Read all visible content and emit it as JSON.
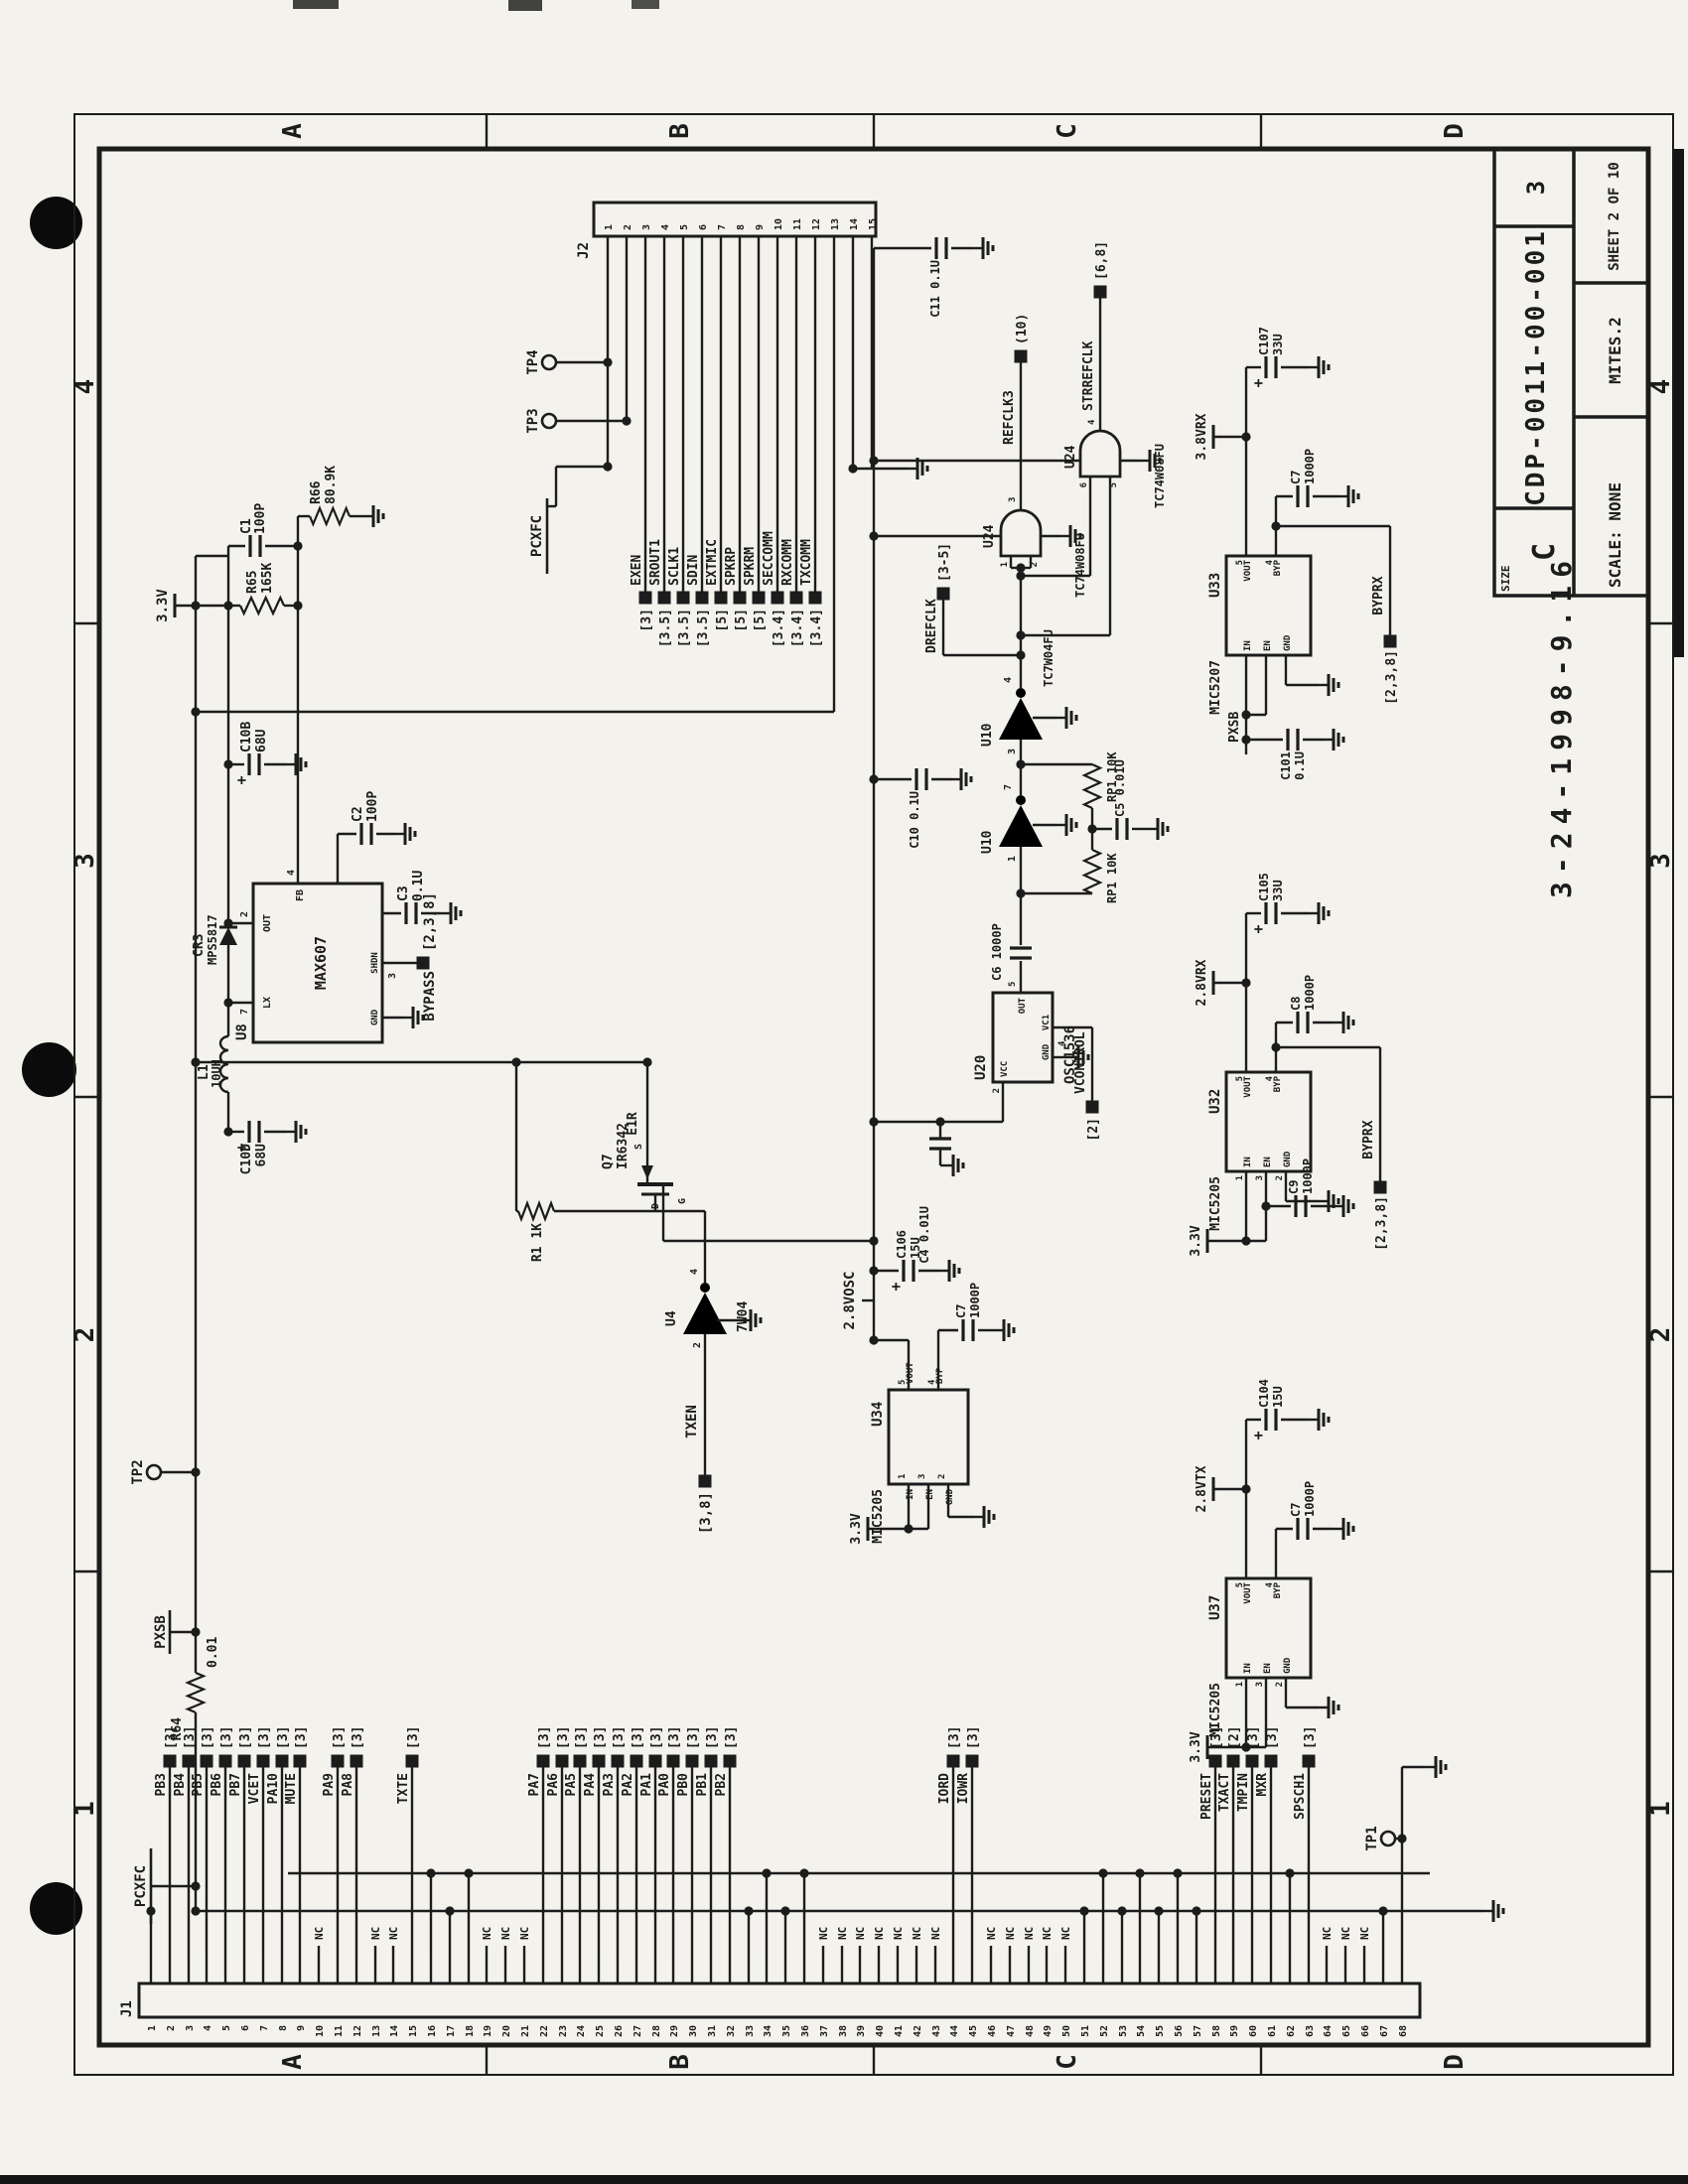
{
  "title_block": {
    "size_label": "SIZE",
    "size": "C",
    "drawing_number": "CDP-0011-00-001",
    "rev": "3",
    "scale": "SCALE: NONE",
    "code": "MITES.2",
    "sheet": "SHEET 2 OF 10",
    "date_stamp": "3-24-1998-9.16"
  },
  "zones": {
    "letters": [
      "A",
      "B",
      "C",
      "D"
    ],
    "numbers": [
      "1",
      "2",
      "3",
      "4"
    ]
  },
  "test_points": [
    "TP1",
    "TP2",
    "TP3",
    "TP4"
  ],
  "power_nets": {
    "v33": "3.3V",
    "v28osc": "2.8VOSC",
    "v28rx": "2.8VRX",
    "v28tx": "2.8VTX",
    "v38rx": "3.8VRX",
    "pxsb": "PXSB",
    "pcxfc": "PCXFC"
  },
  "net_flags": {
    "txen": {
      "net": "TXEN",
      "ref": "[3,8]"
    },
    "bypass": {
      "net": "BYPASS",
      "ref": "[2,3,8]"
    },
    "byprx": {
      "net": "BYPRX",
      "ref": "[2,3,8]"
    },
    "vcontrol": {
      "net": "VCONTROL",
      "ref": "[2]"
    },
    "drefclk": {
      "net": "DREFCLK",
      "ref": "[3-5]"
    },
    "refclk3": {
      "net": "REFCLK3",
      "ref": "(10)"
    },
    "strrefclk": {
      "net": "STRREFCLK",
      "ref": "[6,8]"
    },
    "e1r": {
      "net": "E1R",
      "ref": ""
    }
  },
  "components": {
    "U8": {
      "ref": "U8",
      "part": "MAX607"
    },
    "U10": {
      "ref": "U10",
      "part": "TC7W04FU"
    },
    "U24": {
      "ref": "U24",
      "part": "TC74W08FU"
    },
    "U20": {
      "ref": "U20",
      "part": "OSC1536"
    },
    "U4": {
      "ref": "U4",
      "part": "7W04"
    },
    "U32": {
      "ref": "U32",
      "part": "MIC5205"
    },
    "U33": {
      "ref": "U33",
      "part": "MIC5207"
    },
    "U34": {
      "ref": "U34",
      "part": "MIC5205"
    },
    "U37": {
      "ref": "U37",
      "part": "MIC5205"
    },
    "Q7": {
      "ref": "Q7",
      "part": "IR6342"
    },
    "L1": {
      "ref": "L1",
      "value": "10UH"
    },
    "CR3": {
      "ref": "CR3",
      "part": "MPS5817"
    },
    "R1": {
      "ref": "R1",
      "value": "1K"
    },
    "R64": {
      "ref": "R64",
      "value": "0.01"
    },
    "R65": {
      "ref": "R65",
      "value": "165K"
    },
    "R66": {
      "ref": "R66",
      "value": "80.9K"
    },
    "RP1": {
      "ref": "RP1",
      "value": "10K"
    },
    "C1": {
      "ref": "C1",
      "value": "100P"
    },
    "C2": {
      "ref": "C2",
      "value": "100P"
    },
    "C3": {
      "ref": "C3",
      "value": "0.1U"
    },
    "C4": {
      "ref": "C4",
      "value": "0.01U"
    },
    "C5": {
      "ref": "C5",
      "value": "0.01U"
    },
    "C6": {
      "ref": "C6",
      "value": "1000P"
    },
    "C7": {
      "ref": "C7",
      "value": "1000P"
    },
    "C8": {
      "ref": "C8",
      "value": "1000P"
    },
    "C9": {
      "ref": "C9",
      "value": "1000P"
    },
    "C10": {
      "ref": "C10",
      "value": "0.1U"
    },
    "C11": {
      "ref": "C11",
      "value": "0.1U"
    },
    "C101": {
      "ref": "C101",
      "value": "0.1U"
    },
    "C104": {
      "ref": "C104",
      "value": "15U"
    },
    "C105": {
      "ref": "C105",
      "value": "33U"
    },
    "C106": {
      "ref": "C106",
      "value": "15U"
    },
    "C107": {
      "ref": "C107",
      "value": "33U"
    },
    "C10B": {
      "ref": "C10B",
      "value": "68U"
    },
    "C10D": {
      "ref": "C10D",
      "value": "68U"
    }
  },
  "pin_names": {
    "in": "IN",
    "en": "EN",
    "gnd": "GND",
    "vout": "VOUT",
    "byp": "BYP",
    "vcc": "VCC",
    "out": "OUT",
    "lx": "LX",
    "fb": "FB",
    "shdn": "SHDN",
    "vc1": "VC1",
    "g": "G",
    "s": "S",
    "d": "D"
  },
  "nc": "NC",
  "connectors": {
    "J2": {
      "label": "J2",
      "pin_count": 15,
      "net_labels": [
        {
          "pin": 3,
          "net": "EXEN",
          "ref": "[3]"
        },
        {
          "pin": 4,
          "net": "SROUT1",
          "ref": "[3.5]"
        },
        {
          "pin": 5,
          "net": "SCLK1",
          "ref": "[3.5]"
        },
        {
          "pin": 6,
          "net": "SDIN",
          "ref": "[3.5]"
        },
        {
          "pin": 7,
          "net": "EXTMIC",
          "ref": "[5]"
        },
        {
          "pin": 8,
          "net": "SPKRP",
          "ref": "[5]"
        },
        {
          "pin": 9,
          "net": "SPKRM",
          "ref": "[5]"
        },
        {
          "pin": 10,
          "net": "SECCOMM",
          "ref": "[3.4]"
        },
        {
          "pin": 11,
          "net": "RXCOMM",
          "ref": "[3.4]"
        },
        {
          "pin": 12,
          "net": "TXCOMM",
          "ref": "[3.4]"
        }
      ]
    },
    "J1": {
      "label": "J1",
      "pin_count": 68,
      "net_labels": [
        {
          "pin": 2,
          "net": "PB3",
          "ref": "[3]"
        },
        {
          "pin": 3,
          "net": "PB4",
          "ref": "[3]"
        },
        {
          "pin": 4,
          "net": "PB5",
          "ref": "[3]"
        },
        {
          "pin": 5,
          "net": "PB6",
          "ref": "[3]"
        },
        {
          "pin": 6,
          "net": "PB7",
          "ref": "[3]"
        },
        {
          "pin": 7,
          "net": "VCET",
          "ref": "[3]"
        },
        {
          "pin": 8,
          "net": "PA10",
          "ref": "[3]"
        },
        {
          "pin": 9,
          "net": "MUTE",
          "ref": "[3]"
        },
        {
          "pin": 11,
          "net": "PA9",
          "ref": "[3]"
        },
        {
          "pin": 12,
          "net": "PA8",
          "ref": "[3]"
        },
        {
          "pin": 15,
          "net": "TXTE",
          "ref": "[3]"
        },
        {
          "pin": 22,
          "net": "PA7",
          "ref": "[3]"
        },
        {
          "pin": 23,
          "net": "PA6",
          "ref": "[3]"
        },
        {
          "pin": 24,
          "net": "PA5",
          "ref": "[3]"
        },
        {
          "pin": 25,
          "net": "PA4",
          "ref": "[3]"
        },
        {
          "pin": 26,
          "net": "PA3",
          "ref": "[3]"
        },
        {
          "pin": 27,
          "net": "PA2",
          "ref": "[3]"
        },
        {
          "pin": 28,
          "net": "PA1",
          "ref": "[3]"
        },
        {
          "pin": 29,
          "net": "PA0",
          "ref": "[3]"
        },
        {
          "pin": 30,
          "net": "PB0",
          "ref": "[3]"
        },
        {
          "pin": 31,
          "net": "PB1",
          "ref": "[3]"
        },
        {
          "pin": 32,
          "net": "PB2",
          "ref": "[3]"
        },
        {
          "pin": 44,
          "net": "IORD",
          "ref": "[3]"
        },
        {
          "pin": 45,
          "net": "IOWR",
          "ref": "[3]"
        },
        {
          "pin": 58,
          "net": "PRESET",
          "ref": "[3]"
        },
        {
          "pin": 59,
          "net": "TXACT",
          "ref": "[2]"
        },
        {
          "pin": 60,
          "net": "TMPIN",
          "ref": "[3]"
        },
        {
          "pin": 61,
          "net": "MXR",
          "ref": "[3]"
        },
        {
          "pin": 63,
          "net": "SPSCH1",
          "ref": "[3]"
        }
      ],
      "nc_pins": [
        10,
        13,
        14,
        19,
        20,
        21,
        37,
        38,
        39,
        40,
        41,
        42,
        43,
        46,
        47,
        48,
        49,
        50,
        64,
        65,
        66
      ],
      "bus1_pins": [
        1,
        17,
        33,
        35,
        51,
        53,
        55,
        57,
        67
      ],
      "bus2_pins": [
        16,
        18,
        34,
        36,
        52,
        54,
        56,
        62
      ]
    }
  }
}
